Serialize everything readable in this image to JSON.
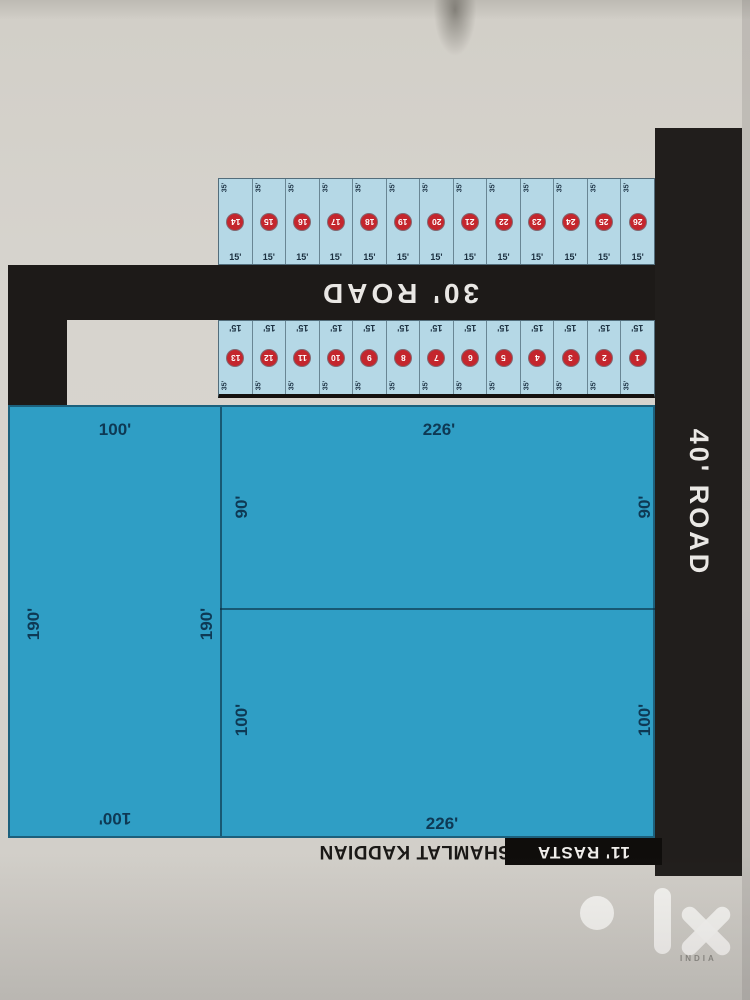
{
  "roads": {
    "right_vertical": "40' ROAD",
    "main_horizontal": "30' ROAD",
    "bottom_lane": "11' RASTA"
  },
  "area_note": "SHAMLAT KADDIAN",
  "strip_plots": {
    "depth_label": "35'",
    "width_label": "15'",
    "upper_row_numbers": [
      "14",
      "15",
      "16",
      "17",
      "18",
      "19",
      "20",
      "21",
      "22",
      "23",
      "24",
      "25",
      "26"
    ],
    "lower_row_numbers": [
      "13",
      "12",
      "11",
      "10",
      "9",
      "8",
      "7",
      "6",
      "5",
      "4",
      "3",
      "2",
      "1"
    ]
  },
  "blocks": {
    "left": {
      "top": "100'",
      "side_left": "190'",
      "side_right": "190'",
      "bottom": "100'"
    },
    "middle_upper": {
      "top": "226'",
      "side_left": "90'",
      "side_right": "90'"
    },
    "middle_lower": {
      "side_left": "100'",
      "side_right": "100'",
      "bottom": "226'"
    }
  },
  "watermark": {
    "brand": "olx",
    "region": "INDIA"
  },
  "colors": {
    "road_black": "#1d1a18",
    "plot_cyan": "#2f9ec5",
    "strip_plot_blue": "#b5d8e6",
    "number_circle_red": "#c4262d",
    "dimension_text_navy": "#0e3954",
    "paper_gray": "#d6d3cd"
  }
}
